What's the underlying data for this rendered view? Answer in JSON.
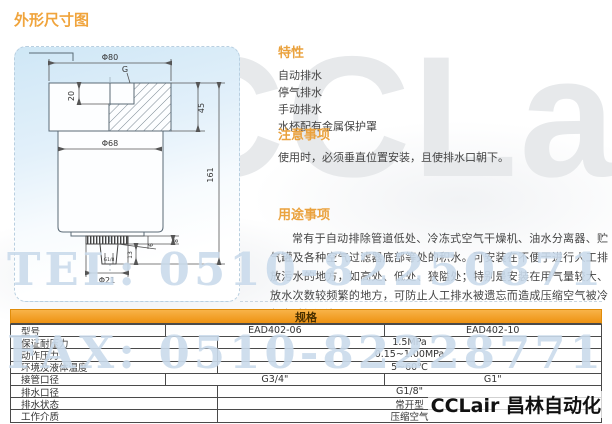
{
  "page": {
    "title": "外形尺寸图"
  },
  "watermarks": {
    "brand": "CCLair",
    "tel": "TEL: 0510-82250871",
    "fax": "FAX: 0510-82228771"
  },
  "logo": {
    "text": "CCLair 昌林自动化"
  },
  "drawing": {
    "dims": {
      "d80": "Φ80",
      "g": "G",
      "d20": "20",
      "d45": "45",
      "d68": "Φ68",
      "d161": "161",
      "d8": "8",
      "d6": "6",
      "d13": "13",
      "stem": "G1/8",
      "d21": "Φ21"
    }
  },
  "sections": {
    "features": {
      "title": "特性",
      "items": [
        "自动排水",
        "停气排水",
        "手动排水",
        "水杯配有金属保护罩"
      ]
    },
    "notes": {
      "title": "注意事项",
      "text": "使用时，必须垂直位置安装，且使排水口朝下。"
    },
    "usage": {
      "title": "用途事项",
      "text": "常有于自动排除管道低处、冷冻式空气干燥机、油水分离器、贮气罐及各种空气过滤器底部等处的积水。可安装在不便于进行人工排放污水的地方，如高处、低处、狭隘处；特别是安装在用气量较大、放水次数较频繁的地方，可防止人工排水被遗忘而造成压缩空气被冷凝水重新污染。"
    }
  },
  "spec_table": {
    "title": "规格",
    "rows": [
      {
        "label": "型号",
        "values": [
          "EAD402-06",
          "EAD402-10"
        ]
      },
      {
        "label": "保证耐压力",
        "values": [
          "1.5MPa"
        ]
      },
      {
        "label": "动作压力",
        "values": [
          "0.15~1.00MPa"
        ]
      },
      {
        "label": "环境及液体温度",
        "values": [
          "5~60℃"
        ]
      },
      {
        "label": "接管口径",
        "values": [
          "G3/4\"",
          "G1\""
        ]
      },
      {
        "label": "排水口径",
        "values": [
          "G1/8\""
        ]
      },
      {
        "label": "排水状态",
        "values": [
          "常开型"
        ]
      },
      {
        "label": "工作介质",
        "values": [
          "压缩空气"
        ]
      }
    ]
  },
  "colors": {
    "accent": "#eaa23e",
    "table_header_from": "#f8b348",
    "table_header_to": "#ee9212",
    "watermark_blue": "#a0bedc",
    "drawing_bg": "#cfe7f6"
  }
}
